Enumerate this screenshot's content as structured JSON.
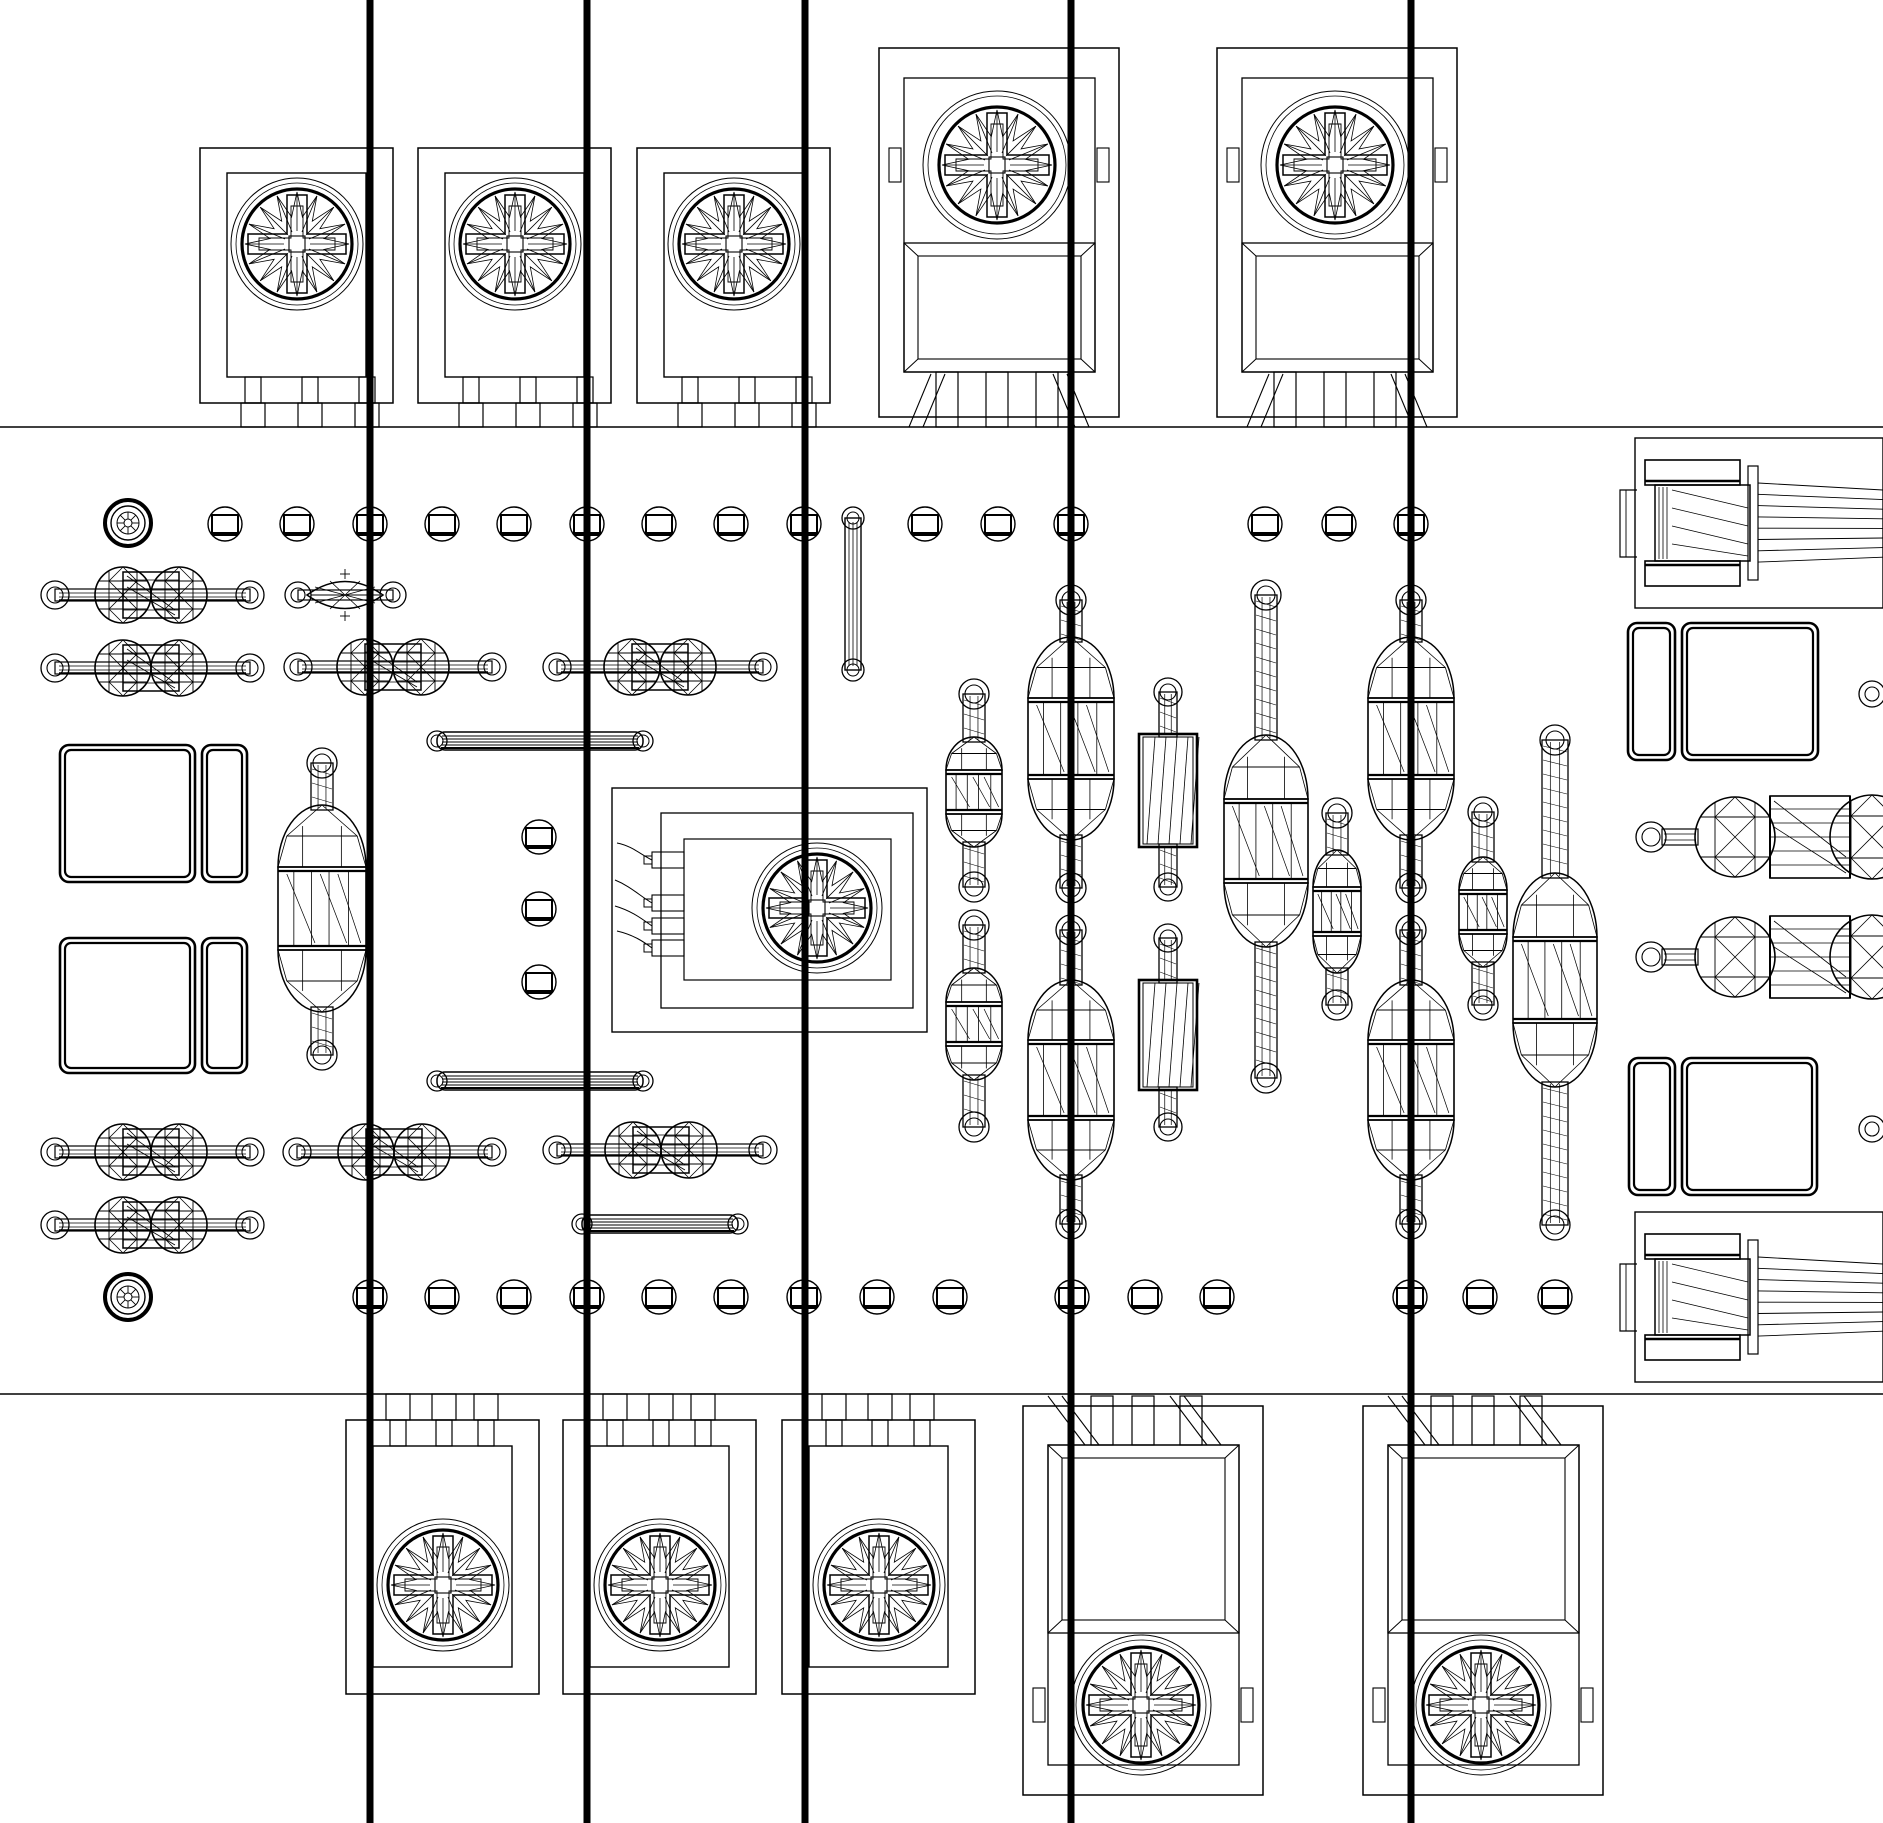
{
  "meta": {
    "title": "pcb-wireframe-top-view",
    "background": "#ffffff",
    "stroke_color": "#000000",
    "accent_red": "#ff0000",
    "canvas": {
      "width": 1883,
      "height": 1823
    }
  },
  "board": {
    "x": 0,
    "width": 1883,
    "top_edge_y": 427,
    "bottom_edge_y": 1394
  },
  "red_lines": {
    "width": 7,
    "xs": [
      370,
      587,
      805,
      1071,
      1411
    ]
  },
  "pads": {
    "row_top": {
      "y": 524,
      "xs": [
        225,
        297,
        370,
        442,
        514,
        587,
        659,
        731,
        804,
        925,
        998,
        1071,
        1265,
        1339,
        1411
      ]
    },
    "row_bottom": {
      "y": 1297,
      "xs": [
        370,
        442,
        514,
        587,
        659,
        731,
        804,
        877,
        950,
        1072,
        1145,
        1217,
        1410,
        1480,
        1555
      ]
    },
    "column": {
      "x": 539,
      "ys": [
        837,
        909,
        982
      ]
    },
    "right_edge": [
      {
        "x": 1872,
        "y": 694
      },
      {
        "x": 1872,
        "y": 1129
      }
    ]
  },
  "mounting_holes": [
    {
      "x": 128,
      "y": 523
    },
    {
      "x": 128,
      "y": 1297
    }
  ],
  "potentiometers": {
    "small_top": {
      "xs": [
        200,
        418,
        637
      ],
      "y": 148,
      "w": 193,
      "h": 255,
      "knob_dy": 96,
      "knob_dx": 97,
      "pin_dxs": [
        53,
        110,
        167
      ]
    },
    "small_bottom": {
      "xs": [
        346,
        563,
        782
      ],
      "y": 1420,
      "w": 193,
      "h": 274,
      "knob_dy": 165,
      "knob_dx": 97,
      "pin_dxs": [
        52,
        98,
        140
      ]
    },
    "large_top": {
      "xs": [
        879,
        1217
      ],
      "y": 48,
      "w": 240,
      "h": 369,
      "knob_dy": 117,
      "knob_dx": 118,
      "pin_dxs": [
        68,
        118,
        168
      ]
    },
    "large_bottom": {
      "xs": [
        1023,
        1363
      ],
      "y": 1406,
      "w": 240,
      "h": 389,
      "knob_dy": 299,
      "knob_dx": 118,
      "pin_dxs": [
        79,
        120,
        168
      ]
    }
  },
  "trimmer_module": {
    "outer": [
      612,
      788,
      315,
      244
    ],
    "mid": [
      661,
      813,
      252,
      195
    ],
    "inner": [
      684,
      839,
      207,
      141
    ],
    "knob": {
      "x": 817,
      "y": 908,
      "r_outer": 65,
      "r_ring": 54
    },
    "pin_ys": [
      860,
      903,
      926,
      948
    ]
  },
  "resistors": [
    {
      "cx": 151,
      "cy": 595,
      "pads": [
        55,
        250
      ]
    },
    {
      "cx": 151,
      "cy": 668,
      "pads": [
        55,
        250
      ]
    },
    {
      "cx": 393,
      "cy": 667,
      "pads": [
        298,
        492
      ]
    },
    {
      "cx": 660,
      "cy": 667,
      "pads": [
        557,
        763
      ]
    },
    {
      "cx": 151,
      "cy": 1152,
      "pads": [
        55,
        250
      ]
    },
    {
      "cx": 394,
      "cy": 1152,
      "pads": [
        297,
        492
      ]
    },
    {
      "cx": 661,
      "cy": 1150,
      "pads": [
        557,
        763
      ]
    },
    {
      "cx": 151,
      "cy": 1225,
      "pads": [
        55,
        250
      ]
    }
  ],
  "diode_lens": {
    "cx": 345,
    "cy": 595,
    "pads": [
      298,
      393
    ],
    "body_x0": 307,
    "body_x1": 383,
    "half_h": 27
  },
  "jumper_rods": [
    {
      "x0": 437,
      "x1": 643,
      "cy": 741
    },
    {
      "x0": 437,
      "x1": 643,
      "cy": 1081
    },
    {
      "x0": 582,
      "x1": 738,
      "cy": 1224
    }
  ],
  "via_link": {
    "cx": 853,
    "y0": 518,
    "y1": 670
  },
  "capacitors": {
    "big": [
      {
        "cx": 322,
        "padT": 763,
        "top": 805,
        "bot": 1012,
        "padB": 1055,
        "w": 88
      },
      {
        "cx": 1071,
        "padT": 600,
        "top": 637,
        "bot": 840,
        "padB": 888,
        "w": 86
      },
      {
        "cx": 1071,
        "padT": 930,
        "top": 980,
        "bot": 1180,
        "padB": 1224,
        "w": 86
      },
      {
        "cx": 1411,
        "padT": 600,
        "top": 637,
        "bot": 840,
        "padB": 888,
        "w": 86
      },
      {
        "cx": 1411,
        "padT": 930,
        "top": 980,
        "bot": 1180,
        "padB": 1224,
        "w": 86
      },
      {
        "cx": 1266,
        "padT": 595,
        "top": 735,
        "bot": 947,
        "padB": 1078,
        "w": 84
      },
      {
        "cx": 1555,
        "padT": 740,
        "top": 873,
        "bot": 1087,
        "padB": 1225,
        "w": 84,
        "nw": 26
      }
    ],
    "medium": [
      {
        "cx": 974,
        "padT": 694,
        "top": 737,
        "bot": 847,
        "padB": 887,
        "w": 56
      },
      {
        "cx": 974,
        "padT": 925,
        "top": 968,
        "bot": 1080,
        "padB": 1127,
        "w": 56
      }
    ],
    "small": [
      {
        "cx": 1337,
        "padT": 813,
        "top": 850,
        "bot": 973,
        "padB": 1005,
        "w": 48
      },
      {
        "cx": 1483,
        "padT": 812,
        "top": 857,
        "bot": 967,
        "padB": 1005,
        "w": 48
      }
    ],
    "box": [
      {
        "cx": 1168,
        "padT": 692,
        "top": 734,
        "bot": 847,
        "padB": 887,
        "w": 58
      },
      {
        "cx": 1168,
        "padT": 938,
        "top": 980,
        "bot": 1090,
        "padB": 1127,
        "w": 58
      }
    ],
    "horizontal": [
      {
        "cy": 837
      },
      {
        "cy": 957
      }
    ]
  },
  "square_pads": [
    {
      "sq": [
        60,
        745,
        135,
        137
      ],
      "bar": [
        202,
        745,
        45,
        137
      ]
    },
    {
      "sq": [
        60,
        938,
        135,
        135
      ],
      "bar": [
        202,
        938,
        45,
        135
      ]
    },
    {
      "sq": [
        1682,
        623,
        136,
        137
      ],
      "bar": [
        1628,
        623,
        47,
        137
      ]
    },
    {
      "sq": [
        1682,
        1058,
        135,
        137
      ],
      "bar": [
        1629,
        1058,
        46,
        137
      ]
    }
  ],
  "connectors": [
    {
      "y": 438
    },
    {
      "y": 1212
    }
  ]
}
